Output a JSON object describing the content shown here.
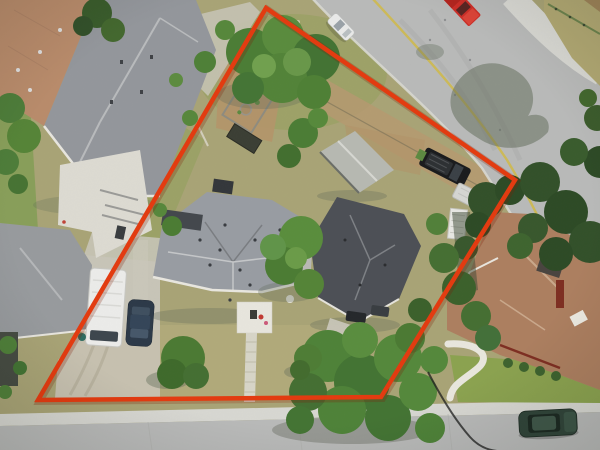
{
  "scene": {
    "type": "aerial-drone-photograph",
    "subject": "overhead view of a residential lot outlined with a red property boundary",
    "width": 600,
    "height": 450
  },
  "boundary": {
    "points": "266,8 515,180 381,397 38,400",
    "color": "#e43b10",
    "shadow_color": "#7e1d04",
    "stroke_width": 4.5
  },
  "colors": {
    "grass_base": "#a9a476",
    "grass_green": "#7c9c4e",
    "lawn_dry": "#b3ab7c",
    "lawn_green": "#8ca350",
    "dirt": "#b79a70",
    "gravel": "#c7c1b0",
    "pavement_pad": "#c8c5b8",
    "road_asphalt": "#b9bab9",
    "road_concrete": "#d8d8d2",
    "sidewalk": "#d9d9d3",
    "center_line": "#cdb952",
    "white_trim": "#e8e6de",
    "tree_green": "#55853a",
    "tree_dark": "#33512a",
    "shadow": "#5f6a58",
    "cable": "#1d1d1d"
  },
  "buildings": [
    {
      "name": "neighbor-house-northwest-brown-roof",
      "color": "#b98c6b"
    },
    {
      "name": "neighbor-house-northwest-gray-roof",
      "color": "#94979c"
    },
    {
      "name": "neighbor-house-northwest-lower-wing",
      "color": "#989b9e"
    },
    {
      "name": "subject-main-house-roof",
      "color": "#999da3"
    },
    {
      "name": "subject-rear-house-roof",
      "color": "#4d5056"
    },
    {
      "name": "detached-garage-roof",
      "color": "#b7b9b2"
    },
    {
      "name": "neighbor-house-southeast-roof",
      "color": "#ad7f60"
    }
  ],
  "vehicles": [
    {
      "name": "red-pickup-truck",
      "color": "#cc2f28",
      "location": "upper street"
    },
    {
      "name": "white-parked-car",
      "color": "#e9eae9",
      "location": "upper street curb"
    },
    {
      "name": "white-rv-trailer",
      "color": "#ececea",
      "location": "west driveway"
    },
    {
      "name": "dark-blue-car",
      "color": "#2d3a49",
      "location": "west driveway"
    },
    {
      "name": "black-truck",
      "color": "#1a1b1d",
      "location": "rear parking"
    },
    {
      "name": "white-utility-trailer",
      "color": "#d5d6d2",
      "location": "rear parking"
    },
    {
      "name": "white-camper",
      "color": "#e8e8e4",
      "location": "east fence line"
    },
    {
      "name": "dark-green-suv",
      "color": "#31453a",
      "location": "bottom street"
    },
    {
      "name": "rear-parked-car-a",
      "color": "#25282b",
      "location": "behind rear house"
    },
    {
      "name": "rear-parked-car-b",
      "color": "#3a3e42",
      "location": "behind rear house"
    }
  ]
}
